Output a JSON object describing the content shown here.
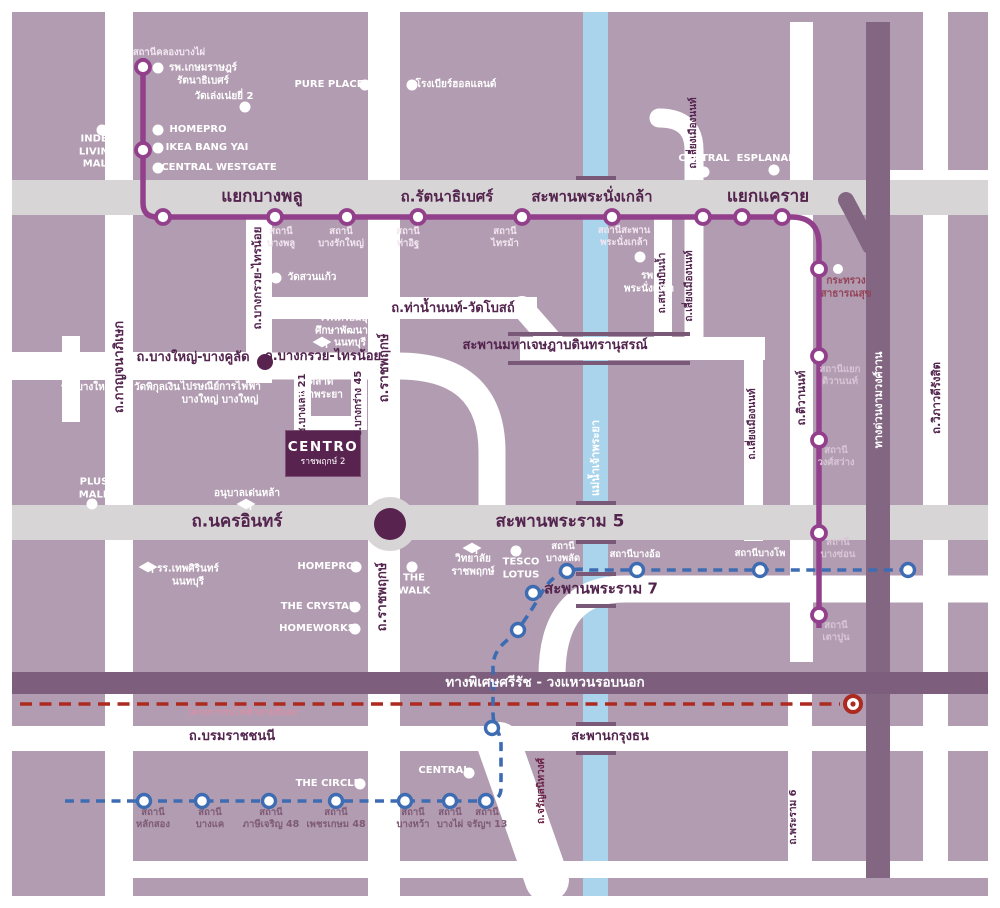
{
  "colors": {
    "map_bg": "#b29cb1",
    "road_white": "#ffffff",
    "road_gray": "#d8d5d6",
    "river": "#a9d4ec",
    "purple_line": "#93408c",
    "blue_line": "#3e6cb3",
    "red_line": "#ac2a20",
    "dark_band": "#826682",
    "expressway": "#7d5e7d",
    "ink": "#53244e",
    "centro_bg": "#592350",
    "bridge_edge": "#7a5878"
  },
  "centro": {
    "name": "CENTRO",
    "sub": "ราชพฤกษ์ 2"
  },
  "labels": [
    {
      "name": "junction-bang-phlu",
      "text": "แยกบางพลู",
      "x": 262,
      "y": 197,
      "cls": "jr"
    },
    {
      "name": "road-rattanathibet",
      "text": "ถ.รัตนาธิเบศร์",
      "x": 447,
      "y": 197,
      "cls": "jr2"
    },
    {
      "name": "bridge-phra-nangklao",
      "text": "สะพานพระนั่งเกล้า",
      "x": 592,
      "y": 197,
      "cls": "jr2"
    },
    {
      "name": "junction-khae-rai",
      "text": "แยกแคราย",
      "x": 768,
      "y": 197,
      "cls": "jr"
    },
    {
      "name": "road-nakhon-in",
      "text": "ถ.นครอินทร์",
      "x": 237,
      "y": 522,
      "cls": "jr"
    },
    {
      "name": "bridge-rama5",
      "text": "สะพานพระราม 5",
      "x": 560,
      "y": 522,
      "cls": "jr"
    },
    {
      "name": "bridge-rama7",
      "text": "สะพานพระราม 7",
      "x": 601,
      "y": 589,
      "cls": "jr2"
    },
    {
      "name": "road-tha-nam-non",
      "text": "ถ.ท่าน้ำนนท์-วัดโบสถ์",
      "x": 453,
      "y": 309,
      "cls": "rd"
    },
    {
      "name": "bridge-maha-chesadabodin",
      "text": "สะพานมหาเจษฎาบดินทรานุสรณ์",
      "x": 555,
      "y": 346,
      "cls": "rd"
    },
    {
      "name": "road-bang-yai-bang-khulat",
      "text": "ถ.บางใหญ่-บางคูลัด",
      "x": 193,
      "y": 358,
      "cls": "rd"
    },
    {
      "name": "road-bang-kruai-sai-noi-horizontal",
      "text": "ถ.บางกรวย-ไทรน้อย",
      "x": 323,
      "y": 357,
      "cls": "rd"
    },
    {
      "name": "road-borommaratchachonnani",
      "text": "ถ.บรมราชชนนี",
      "x": 232,
      "y": 737,
      "cls": "rd"
    },
    {
      "name": "bridge-krung-thon",
      "text": "สะพานกรุงธน",
      "x": 610,
      "y": 737,
      "cls": "rd"
    },
    {
      "name": "expressway-si-rat-label",
      "text": "ทางพิเศษศรีรัช - วงแหวนรอบนอก",
      "x": 545,
      "y": 683,
      "cls": "exp"
    },
    {
      "name": "road-kanchanaphisek",
      "text": "ถ.กาญจนาภิเษก",
      "x": 120,
      "y": 367,
      "cls": "rd v"
    },
    {
      "name": "road-bang-kruai-sai-noi-vertical",
      "text": "ถ.บางกรวย-ไทรน้อย",
      "x": 257,
      "y": 278,
      "cls": "rd-sm v"
    },
    {
      "name": "soi-bang-len-21",
      "text": "ซ.บางเลน 21",
      "x": 303,
      "y": 404,
      "cls": "rd-xs v"
    },
    {
      "name": "soi-bang-krang-45",
      "text": "ซ.บางกร่าง 45",
      "x": 359,
      "y": 404,
      "cls": "rd-xs v"
    },
    {
      "name": "road-ratchaphruek-upper",
      "text": "ถ.ราชพฤกษ์",
      "x": 385,
      "y": 368,
      "cls": "rd v"
    },
    {
      "name": "road-ratchaphruek-lower",
      "text": "ถ.ราชพฤกษ์",
      "x": 383,
      "y": 597,
      "cls": "rd v"
    },
    {
      "name": "road-sanam-bin-nam",
      "text": "ถ.สนามบินน้ำ",
      "x": 663,
      "y": 283,
      "cls": "rd-xs v"
    },
    {
      "name": "road-liang-mueang-non-top",
      "text": "ถ.เลี่ยงเมืองนนท์",
      "x": 694,
      "y": 133,
      "cls": "rd-xs v"
    },
    {
      "name": "road-liang-mueang-non-mid",
      "text": "ถ.เลี่ยงเมืองนนท์",
      "x": 690,
      "y": 286,
      "cls": "rd-xs v"
    },
    {
      "name": "road-liang-mueang-non-lower",
      "text": "ถ.เลี่ยงเมืองนนท์",
      "x": 753,
      "y": 424,
      "cls": "rd-xs v"
    },
    {
      "name": "road-tiwanon",
      "text": "ถ.ติวานนท์",
      "x": 801,
      "y": 398,
      "cls": "rd-sm v"
    },
    {
      "name": "road-vibhavadi-rangsit",
      "text": "ถ.วิภาวดีรังสิต",
      "x": 936,
      "y": 398,
      "cls": "rd-sm v"
    },
    {
      "name": "road-charan-sanitwong",
      "text": "ถ.จรัญสนิทวงศ์",
      "x": 542,
      "y": 791,
      "cls": "rd-xs v plum2"
    },
    {
      "name": "road-rama6",
      "text": "ถ.พระราม 6",
      "x": 794,
      "y": 817,
      "cls": "rd-xs v"
    },
    {
      "name": "river-chao-phraya-label",
      "text": "แม่น้ำเจ้าพระยา",
      "x": 596,
      "y": 458,
      "cls": "riv v"
    },
    {
      "name": "expressway-ngam-wong-wan-label",
      "text": "ทางด่วนงามวงศ์วาน",
      "x": 879,
      "y": 400,
      "cls": "riv v"
    },
    {
      "name": "station-khlong-bang-phai-label",
      "text": "สถานีคลองบางไผ่",
      "x": 169,
      "y": 53,
      "cls": "stp"
    },
    {
      "name": "poi-kasemrad-hospital",
      "text": "รพ.เกษมราษฎร์\nรัตนาธิเบศร์",
      "x": 203,
      "y": 75,
      "cls": "poi"
    },
    {
      "name": "poi-wat-leng-noei-yi-2",
      "text": "วัดเล่งเน่ยยี่ 2",
      "x": 224,
      "y": 97,
      "cls": "poi"
    },
    {
      "name": "poi-homepro-bang-yai",
      "text": "HOMEPRO",
      "x": 198,
      "y": 130,
      "cls": "poi"
    },
    {
      "name": "poi-ikea-bang-yai",
      "text": "IKEA BANG YAI",
      "x": 207,
      "y": 148,
      "cls": "poi"
    },
    {
      "name": "poi-central-westgate",
      "text": "CENTRAL WESTGATE",
      "x": 219,
      "y": 168,
      "cls": "poi"
    },
    {
      "name": "poi-index-living-mall",
      "text": "INDEX\nLIVING\nMALL",
      "x": 98,
      "y": 152,
      "cls": "poi"
    },
    {
      "name": "poi-pure-place",
      "text": "PURE PLACE",
      "x": 329,
      "y": 85,
      "cls": "poi"
    },
    {
      "name": "poi-holland-beer-house",
      "text": "โรงเบียร์ฮอลแลนด์",
      "x": 456,
      "y": 85,
      "cls": "poi"
    },
    {
      "name": "poi-wat-suan-kaew",
      "text": "วัดสวนแก้ว",
      "x": 312,
      "y": 278,
      "cls": "poi"
    },
    {
      "name": "poi-phra-nangklao-hospital",
      "text": "รพ.\nพระนั่งเกล้า",
      "x": 649,
      "y": 283,
      "cls": "poi"
    },
    {
      "name": "poi-ministry-of-public-health",
      "text": "กระทรวง\nสาธารณสุข",
      "x": 846,
      "y": 288,
      "cls": "poi plum"
    },
    {
      "name": "poi-bang-yai-hospital",
      "text": "รพ.บางใหญ่",
      "x": 87,
      "y": 388,
      "cls": "poi"
    },
    {
      "name": "poi-wat-phikul-ngoen",
      "text": "วัดพิกุลเงิน",
      "x": 157,
      "y": 388,
      "cls": "poi"
    },
    {
      "name": "poi-post-office-bang-yai",
      "text": "ไปรษณีย์\nบางใหญ่",
      "x": 200,
      "y": 394,
      "cls": "poi"
    },
    {
      "name": "poi-electricity-authority-bang-yai",
      "text": "การไฟฟ้า\nบางใหญ่",
      "x": 240,
      "y": 394,
      "cls": "poi"
    },
    {
      "name": "poi-chao-phraya-market",
      "text": "ตลาด\nเจ้าพระยา",
      "x": 321,
      "y": 389,
      "cls": "poi"
    },
    {
      "name": "poi-triam-udom-nonthaburi-school",
      "text": "รร.เตรียมอุดม\nศึกษาพัฒนาการ\nนนทบุรี",
      "x": 350,
      "y": 331,
      "cls": "poi"
    },
    {
      "name": "poi-plus-mall",
      "text": "PLUS\nMALL",
      "x": 94,
      "y": 489,
      "cls": "poi"
    },
    {
      "name": "poi-anuban-denla",
      "text": "อนุบาลเด่นหล้า",
      "x": 247,
      "y": 494,
      "cls": "poi"
    },
    {
      "name": "poi-debsirin-nonthaburi-school",
      "text": "รร.เทพศิรินทร์\nนนทบุรี",
      "x": 188,
      "y": 576,
      "cls": "poi"
    },
    {
      "name": "poi-homepro-nakhon-in",
      "text": "HOMEPRO",
      "x": 326,
      "y": 567,
      "cls": "poi"
    },
    {
      "name": "poi-the-crystal",
      "text": "THE CRYSTAL",
      "x": 318,
      "y": 607,
      "cls": "poi"
    },
    {
      "name": "poi-homeworks",
      "text": "HOMEWORKS",
      "x": 317,
      "y": 629,
      "cls": "poi"
    },
    {
      "name": "poi-the-walk",
      "text": "THE\nWALK",
      "x": 414,
      "y": 585,
      "cls": "poi"
    },
    {
      "name": "poi-ratchaphruek-college",
      "text": "วิทยาลัย\nราชพฤกษ์",
      "x": 473,
      "y": 566,
      "cls": "poi"
    },
    {
      "name": "poi-tesco-lotus",
      "text": "TESCO\nLOTUS",
      "x": 521,
      "y": 569,
      "cls": "poi"
    },
    {
      "name": "poi-the-circle",
      "text": "THE CIRCLE",
      "x": 328,
      "y": 784,
      "cls": "poi"
    },
    {
      "name": "poi-central-bottom",
      "text": "CENTRAL",
      "x": 444,
      "y": 771,
      "cls": "poi"
    },
    {
      "name": "poi-central-khae-rai",
      "text": "CENTRAL",
      "x": 704,
      "y": 159,
      "cls": "poi"
    },
    {
      "name": "poi-esplanade",
      "text": "ESPLANADE",
      "x": 770,
      "y": 159,
      "cls": "poi"
    },
    {
      "name": "station-bang-phlu-label",
      "text": "สถานี\nบางพลู",
      "x": 281,
      "y": 238,
      "cls": "stp"
    },
    {
      "name": "station-bang-rak-yai-label",
      "text": "สถานี\nบางรักใหญ่",
      "x": 341,
      "y": 238,
      "cls": "stp"
    },
    {
      "name": "station-tha-it-label",
      "text": "สถานี\nท่าอิฐ",
      "x": 408,
      "y": 238,
      "cls": "stp"
    },
    {
      "name": "station-sai-ma-label",
      "text": "สถานี\nไทรม้า",
      "x": 505,
      "y": 238,
      "cls": "stp"
    },
    {
      "name": "station-saphan-phra-nangklao-label",
      "text": "สถานีสะพาน\nพระนั่งเกล้า",
      "x": 624,
      "y": 237,
      "cls": "stp"
    },
    {
      "name": "station-yaek-tiwanon-label",
      "text": "สถานีแยก\nติวานนท์",
      "x": 840,
      "y": 376,
      "cls": "stpr"
    },
    {
      "name": "station-wong-sawang-label",
      "text": "สถานี\nวงศ์สว่าง",
      "x": 836,
      "y": 457,
      "cls": "stpr"
    },
    {
      "name": "station-bang-son-label",
      "text": "สถานี\nบางซ่อน",
      "x": 838,
      "y": 549,
      "cls": "stpr"
    },
    {
      "name": "station-tao-poon-label",
      "text": "สถานี\nเตาปูน",
      "x": 836,
      "y": 632,
      "cls": "stpr"
    },
    {
      "name": "station-bang-phlat-label",
      "text": "สถานี\nบางพลัด",
      "x": 563,
      "y": 553,
      "cls": "stw"
    },
    {
      "name": "station-bang-o-label",
      "text": "สถานีบางอ้อ",
      "x": 635,
      "y": 555,
      "cls": "stw"
    },
    {
      "name": "station-bang-pho-label",
      "text": "สถานีบางโพ",
      "x": 760,
      "y": 554,
      "cls": "stw"
    },
    {
      "name": "station-lak-song-label",
      "text": "สถานี\nหลักสอง",
      "x": 153,
      "y": 819,
      "cls": "stb"
    },
    {
      "name": "station-bang-khae-label",
      "text": "สถานี\nบางแค",
      "x": 210,
      "y": 819,
      "cls": "stb"
    },
    {
      "name": "station-phasi-charoen-48-label",
      "text": "สถานี\nภาษีเจริญ 48",
      "x": 271,
      "y": 819,
      "cls": "stb"
    },
    {
      "name": "station-phetkasem-48-label",
      "text": "สถานี\nเพชรเกษม 48",
      "x": 336,
      "y": 819,
      "cls": "stb"
    },
    {
      "name": "station-bang-wa-label",
      "text": "สถานี\nบางหว้า",
      "x": 413,
      "y": 819,
      "cls": "stb"
    },
    {
      "name": "station-bang-phai-label",
      "text": "สถานี\nบางไผ่",
      "x": 450,
      "y": 819,
      "cls": "stb"
    },
    {
      "name": "station-charan-13-label",
      "text": "สถานี\nจรัญฯ 13",
      "x": 487,
      "y": 819,
      "cls": "stb"
    },
    {
      "name": "red-line-project-label",
      "text": "โครงการรถไฟฟ้าสายสีแดง",
      "x": 242,
      "y": 713,
      "cls": "redl"
    }
  ]
}
